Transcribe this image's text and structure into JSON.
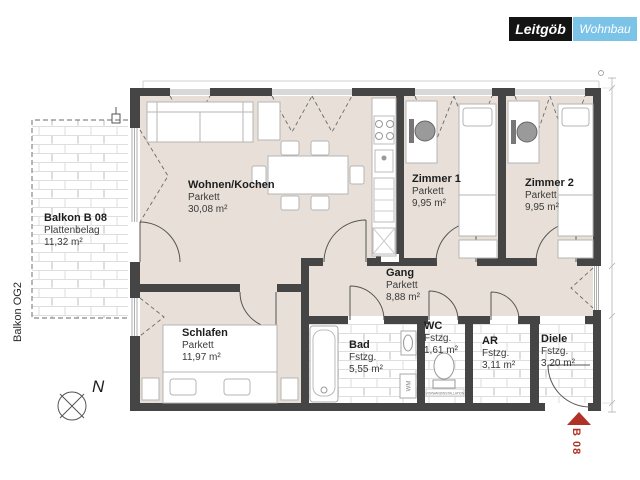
{
  "header": {
    "logo_primary": "Leitgöb",
    "logo_secondary": "Wohnbau"
  },
  "plan": {
    "balcony": {
      "name": "Balkon B 08",
      "surface": "Plattenbelag",
      "area": "11,32 m²"
    },
    "balcony_side_label": "Balkon OG2",
    "rooms": [
      {
        "key": "wohnen",
        "name": "Wohnen/Kochen",
        "surface": "Parkett",
        "area": "30,08 m²"
      },
      {
        "key": "zimmer1",
        "name": "Zimmer 1",
        "surface": "Parkett",
        "area": "9,95 m²"
      },
      {
        "key": "zimmer2",
        "name": "Zimmer 2",
        "surface": "Parkett",
        "area": "9,95 m²"
      },
      {
        "key": "gang",
        "name": "Gang",
        "surface": "Parkett",
        "area": "8,88 m²"
      },
      {
        "key": "schlafen",
        "name": "Schlafen",
        "surface": "Parkett",
        "area": "11,97 m²"
      },
      {
        "key": "bad",
        "name": "Bad",
        "surface": "Fstzg.",
        "area": "5,55 m²"
      },
      {
        "key": "wc",
        "name": "WC",
        "surface": "Fstzg.",
        "area": "1,61 m²"
      },
      {
        "key": "ar",
        "name": "AR",
        "surface": "Fstzg.",
        "area": "3,11 m²"
      },
      {
        "key": "diele",
        "name": "Diele",
        "surface": "Fstzg.",
        "area": "3,20 m²"
      }
    ],
    "annotations": {
      "north": "N",
      "unit_marker": "B 08",
      "wm_label": "WM",
      "wc_note": "VORWANDINSTALLATION"
    }
  },
  "colors": {
    "wall": "#454545",
    "parkett_floor": "#e8e0d8",
    "tile_line": "#dedede",
    "accent_red": "#b03226",
    "logo_black": "#141414",
    "logo_blue": "#7cc3e8"
  }
}
